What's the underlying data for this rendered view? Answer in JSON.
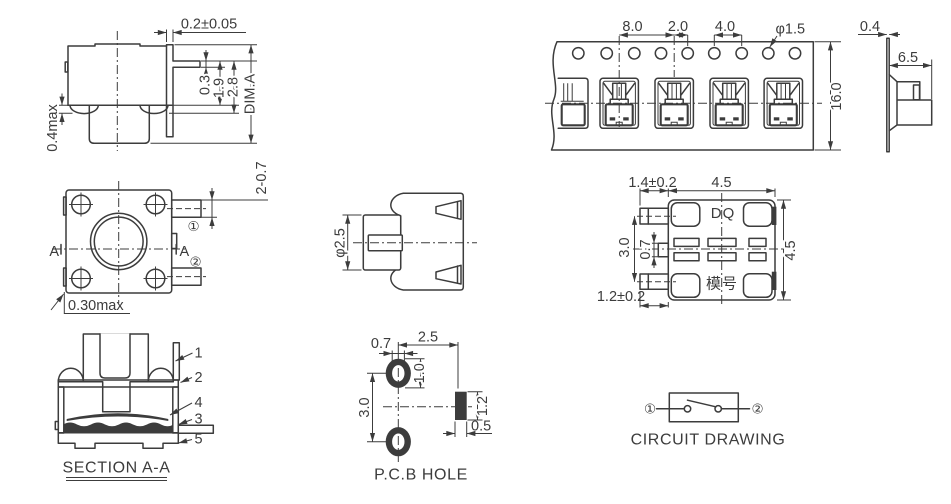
{
  "drawing": {
    "ink": "#3c3c3c",
    "bg": "#ffffff",
    "side_view": {
      "dim_top": "0.2±0.05",
      "dim_pin_thickness": "0.3",
      "dim_pin_to_bottom": "1.9",
      "dim_body_height": "2.8",
      "dim_overall": "DIM.A",
      "dim_standoff": "0.4max"
    },
    "top_view": {
      "dim_terminal": "2-0.7",
      "pin1": "①",
      "pin2": "②",
      "section_left": "A",
      "section_right": "A",
      "dim_tab": "0.30max"
    },
    "section_view": {
      "title": "SECTION A-A",
      "callouts": {
        "c1": "1",
        "c2": "2",
        "c3": "3",
        "c4": "4",
        "c5": "5"
      }
    },
    "stem_view": {
      "dim_stem": "φ2.5"
    },
    "pcb_view": {
      "title": "P.C.B HOLE",
      "dim_hole_width": "0.7",
      "dim_hole_to_pad": "2.5",
      "dim_hole_height": "1.0",
      "dim_hole_pitch": "3.0",
      "dim_pad_height": "1.2",
      "dim_pad_width": "0.5"
    },
    "tape_view": {
      "dim_pocket_pitch": "8.0",
      "dim_pocket_to_hole": "2.0",
      "dim_hole_pitch": "4.0",
      "dim_hole_dia": "φ1.5",
      "dim_tape_width": "16.0"
    },
    "tape_profile": {
      "dim_thickness": "0.4",
      "dim_pocket_depth": "6.5"
    },
    "bottom_view": {
      "dim_terminal_top": "1.4±0.2",
      "dim_body_width": "4.5",
      "dim_terminal_pitch": "3.0",
      "dim_tab_width": "0.7",
      "dim_terminal_bottom": "1.2±0.2",
      "dim_body_height": "4.5",
      "marking_top": "DQ",
      "marking_bottom": "模号"
    },
    "circuit_view": {
      "title": "CIRCUIT DRAWING",
      "pin1": "①",
      "pin2": "②"
    }
  }
}
